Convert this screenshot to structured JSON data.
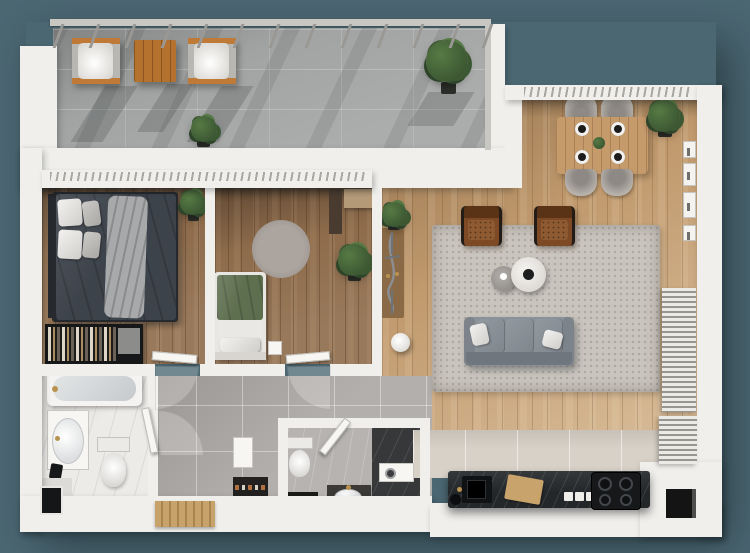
{
  "meta": {
    "description": "3D top-down floor plan rendering of a two-bedroom apartment with terrace",
    "canvas": {
      "width": 750,
      "height": 553
    }
  },
  "palette": {
    "bg": "#4b6772",
    "wall": "#f0efec",
    "wall-dim": "#dddbd7",
    "concrete": "#a2a4a3",
    "wood-a": "#8d6b4b",
    "wood-b": "#c19a6e",
    "tile-hall": "#b3afac",
    "tile-kitchen": "#d8d1c7",
    "marble": "#edebe8",
    "marble-gray": "#b6b3b1",
    "marble-dark": "#37383a",
    "counter": "#24272a",
    "rug": "#c9c4bd",
    "rug-round": "#a29b95",
    "sofa": "#8a9197",
    "sofa-dark": "#6f767d",
    "leather": "#7e4a26",
    "leather-dark": "#5a3317",
    "table-wood": "#c69b6c",
    "chair": "#b7b2ac",
    "bed-dark": "#3d434b",
    "bed-green": "#5e6f4f",
    "throw": "#a7a9ab",
    "plant": "#3c5833",
    "plant-light": "#567a44",
    "plant-dark": "#2e452a",
    "pot": "#2c2e2a",
    "orange": "#c07a38",
    "orange-wood": "#b5722f",
    "gold": "#b9924f",
    "black": "#161718",
    "door": "#f7f6f3",
    "railing": "#c9c7c2",
    "blind": "#eceae6",
    "mat": "#8a6a46",
    "doormat": "#c8a26b",
    "shoe-dark": "#23211f"
  },
  "scene": {
    "rooms": {
      "terrace": "Terrace",
      "master_bedroom": "Bedroom 1",
      "second_bedroom": "Bedroom 2",
      "hallway": "Hallway",
      "bathroom": "Bathroom",
      "toilet_room": "Toilet / Laundry",
      "living_dining": "Living / Dining Room",
      "kitchen": "Kitchen"
    },
    "inventory": [
      {
        "area": "terrace",
        "items": [
          "lounge chair",
          "lounge chair",
          "wooden coffee table",
          "potted plant",
          "potted tree",
          "railing"
        ]
      },
      {
        "area": "master_bedroom",
        "items": [
          "double bed",
          "pillows",
          "throw blanket",
          "potted plant",
          "open wardrobe with clothes",
          "drawer unit"
        ]
      },
      {
        "area": "second_bedroom",
        "items": [
          "single bed",
          "nightstand",
          "round rug",
          "potted plant",
          "wardrobe",
          "dresser"
        ]
      },
      {
        "area": "hallway",
        "items": [
          "shoe rack",
          "wall cabinet",
          "wooden doormat",
          "interior doors"
        ]
      },
      {
        "area": "bathroom",
        "items": [
          "bathtub",
          "washbasin vanity",
          "toilet",
          "waste bin",
          "floor shaft"
        ]
      },
      {
        "area": "toilet_room",
        "items": [
          "toilet",
          "washbasin vanity",
          "washing machine",
          "dark floor mat",
          "walk-in shower"
        ]
      },
      {
        "area": "living_dining",
        "items": [
          "three-seat sofa",
          "white pillow",
          "tan pillow",
          "area rug",
          "leather armchair",
          "leather armchair",
          "round coffee table",
          "round side table",
          "floor pouf",
          "bicycle",
          "entry mat",
          "potted plant",
          "dining table",
          "dining chair",
          "dining chair",
          "dining chair",
          "dining chair",
          "place setting x4",
          "centerpiece plant",
          "corner potted plant",
          "wall panels",
          "slatted radiator"
        ]
      },
      {
        "area": "kitchen",
        "items": [
          "stone counter",
          "sink",
          "faucet",
          "cutting board",
          "kettle",
          "switch plates",
          "cooktop with 4 burners",
          "ventilation shaft",
          "slatted radiator"
        ]
      }
    ]
  }
}
